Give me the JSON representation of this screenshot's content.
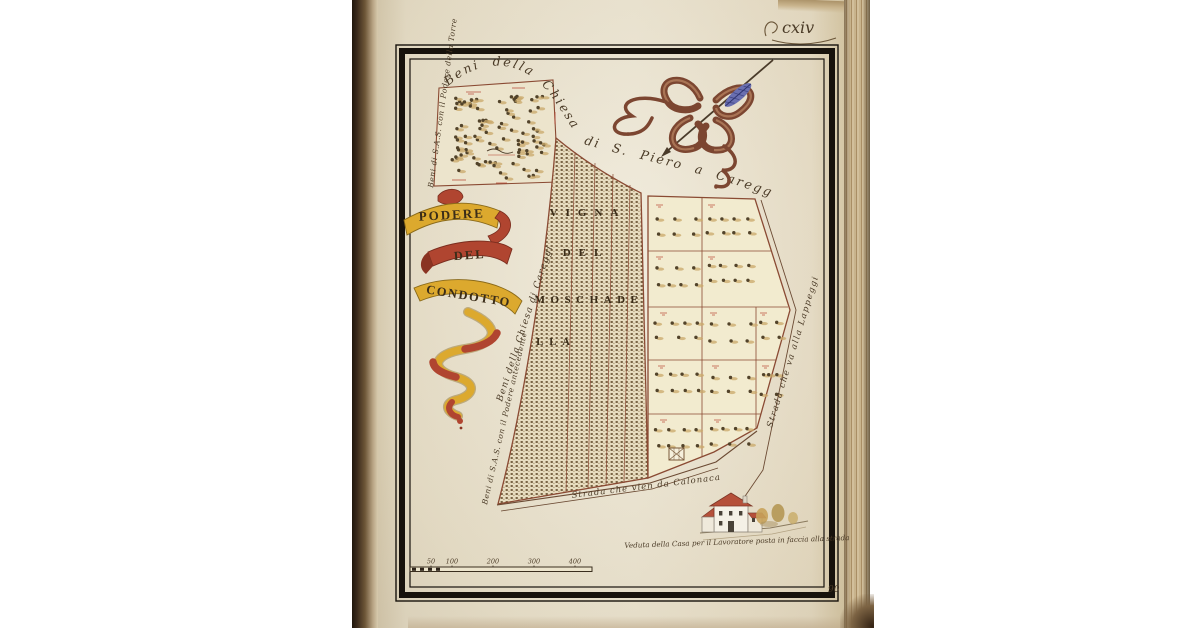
{
  "page": {
    "folio_number": "cxiv",
    "folio_mark": "90"
  },
  "colors": {
    "page_cream": "#ece5d1",
    "frame_black": "#17120c",
    "boundary_brown": "#8a4a33",
    "red_ink": "#b23a28",
    "ink_brown": "#4a3a26",
    "ribbon_yellow": "#dca92e",
    "ribbon_red": "#b04530",
    "roof_red": "#b5503a",
    "feather_blue": "#6a6fb0"
  },
  "map": {
    "banner": {
      "line1": "PODERE",
      "line2": "DEL",
      "line3": "CONDOTTO"
    },
    "arc_title": {
      "part1": "Beni della Chiesa",
      "part2": "di S. Piero a Careggi"
    },
    "vineyard": {
      "line1": "VIGNA",
      "line2": "DEL",
      "line3": "MOSCHADE",
      "line4": "LLA"
    },
    "labels": {
      "inset_side": "Beni di S.A.S. con il Podere della Torre",
      "field_side_church": "Beni della Chiesa di Careggi",
      "field_side_sas": "Beni di S.A.S. con il Podere antecedente",
      "road_bottom": "Strada che vien da Calonaca",
      "road_right": "Strada che va alla Lappeggi",
      "house_caption": "Veduta della Casa per il Lavoratore posta in faccia alla strada"
    },
    "scale": {
      "tick_labels": [
        "50",
        "100",
        "200",
        "300",
        "400"
      ]
    }
  }
}
